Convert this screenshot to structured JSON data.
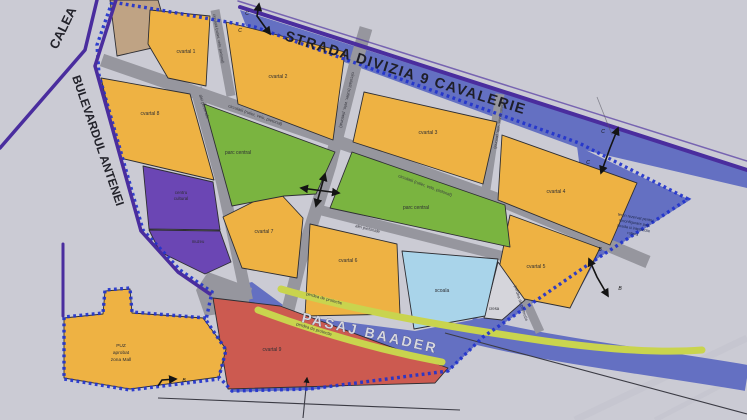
{
  "streets": {
    "divizia": "STRADA DIVIZIA 9 CAVALERIE",
    "calea": "CALEA",
    "antenei": "BULEVARDUL ANTENEI",
    "pasaj": "PASAJ BAADER",
    "circulatii": "circulatii (rutier, velo, pietonal)",
    "alei": "alei pietonale",
    "perdea": "perdea de protectie"
  },
  "zones": {
    "cvartal1": "cvartal 1",
    "cvartal2": "cvartal 2",
    "cvartal3": "cvartal 3",
    "cvartal4": "cvartal 4",
    "cvartal5": "cvartal 5",
    "cvartal6": "cvartal 6",
    "cvartal7": "cvartal 7",
    "cvartal8": "cvartal 8",
    "cvartal9": "cvartal 9",
    "parc": "parc central",
    "centru_line1": "centru",
    "centru_line2": "cultural",
    "muzeu": "muzeu",
    "scoala": "scoala",
    "cresa": "cresa",
    "puz_line1": "PUZ",
    "puz_line2": "aprobat",
    "puz_line3": "zona Mall",
    "teren_line1": "teren rezervat pentru",
    "teren_line2": "reconfigurare pod,",
    "teren_line3": "strada si intersectie",
    "teren_line4": "rutiera"
  },
  "markers": {
    "c": "C",
    "b": "B"
  },
  "colors": {
    "paper": "#cbcbd4",
    "block_orange": "#eeb243",
    "park_green": "#7ab440",
    "civic_purple": "#6b46b4",
    "mixed_red": "#cc5a50",
    "school_blue": "#a9d4ea",
    "band_blue": "#6470c2",
    "strip_green": "#c9d44e",
    "street_gray": "#96969e",
    "roadline_purple": "#4a2d9e",
    "boundary_blue": "#2233cc",
    "tan": "#bfa384",
    "cresa_gray": "#d5d5db",
    "ink": "#141414"
  }
}
